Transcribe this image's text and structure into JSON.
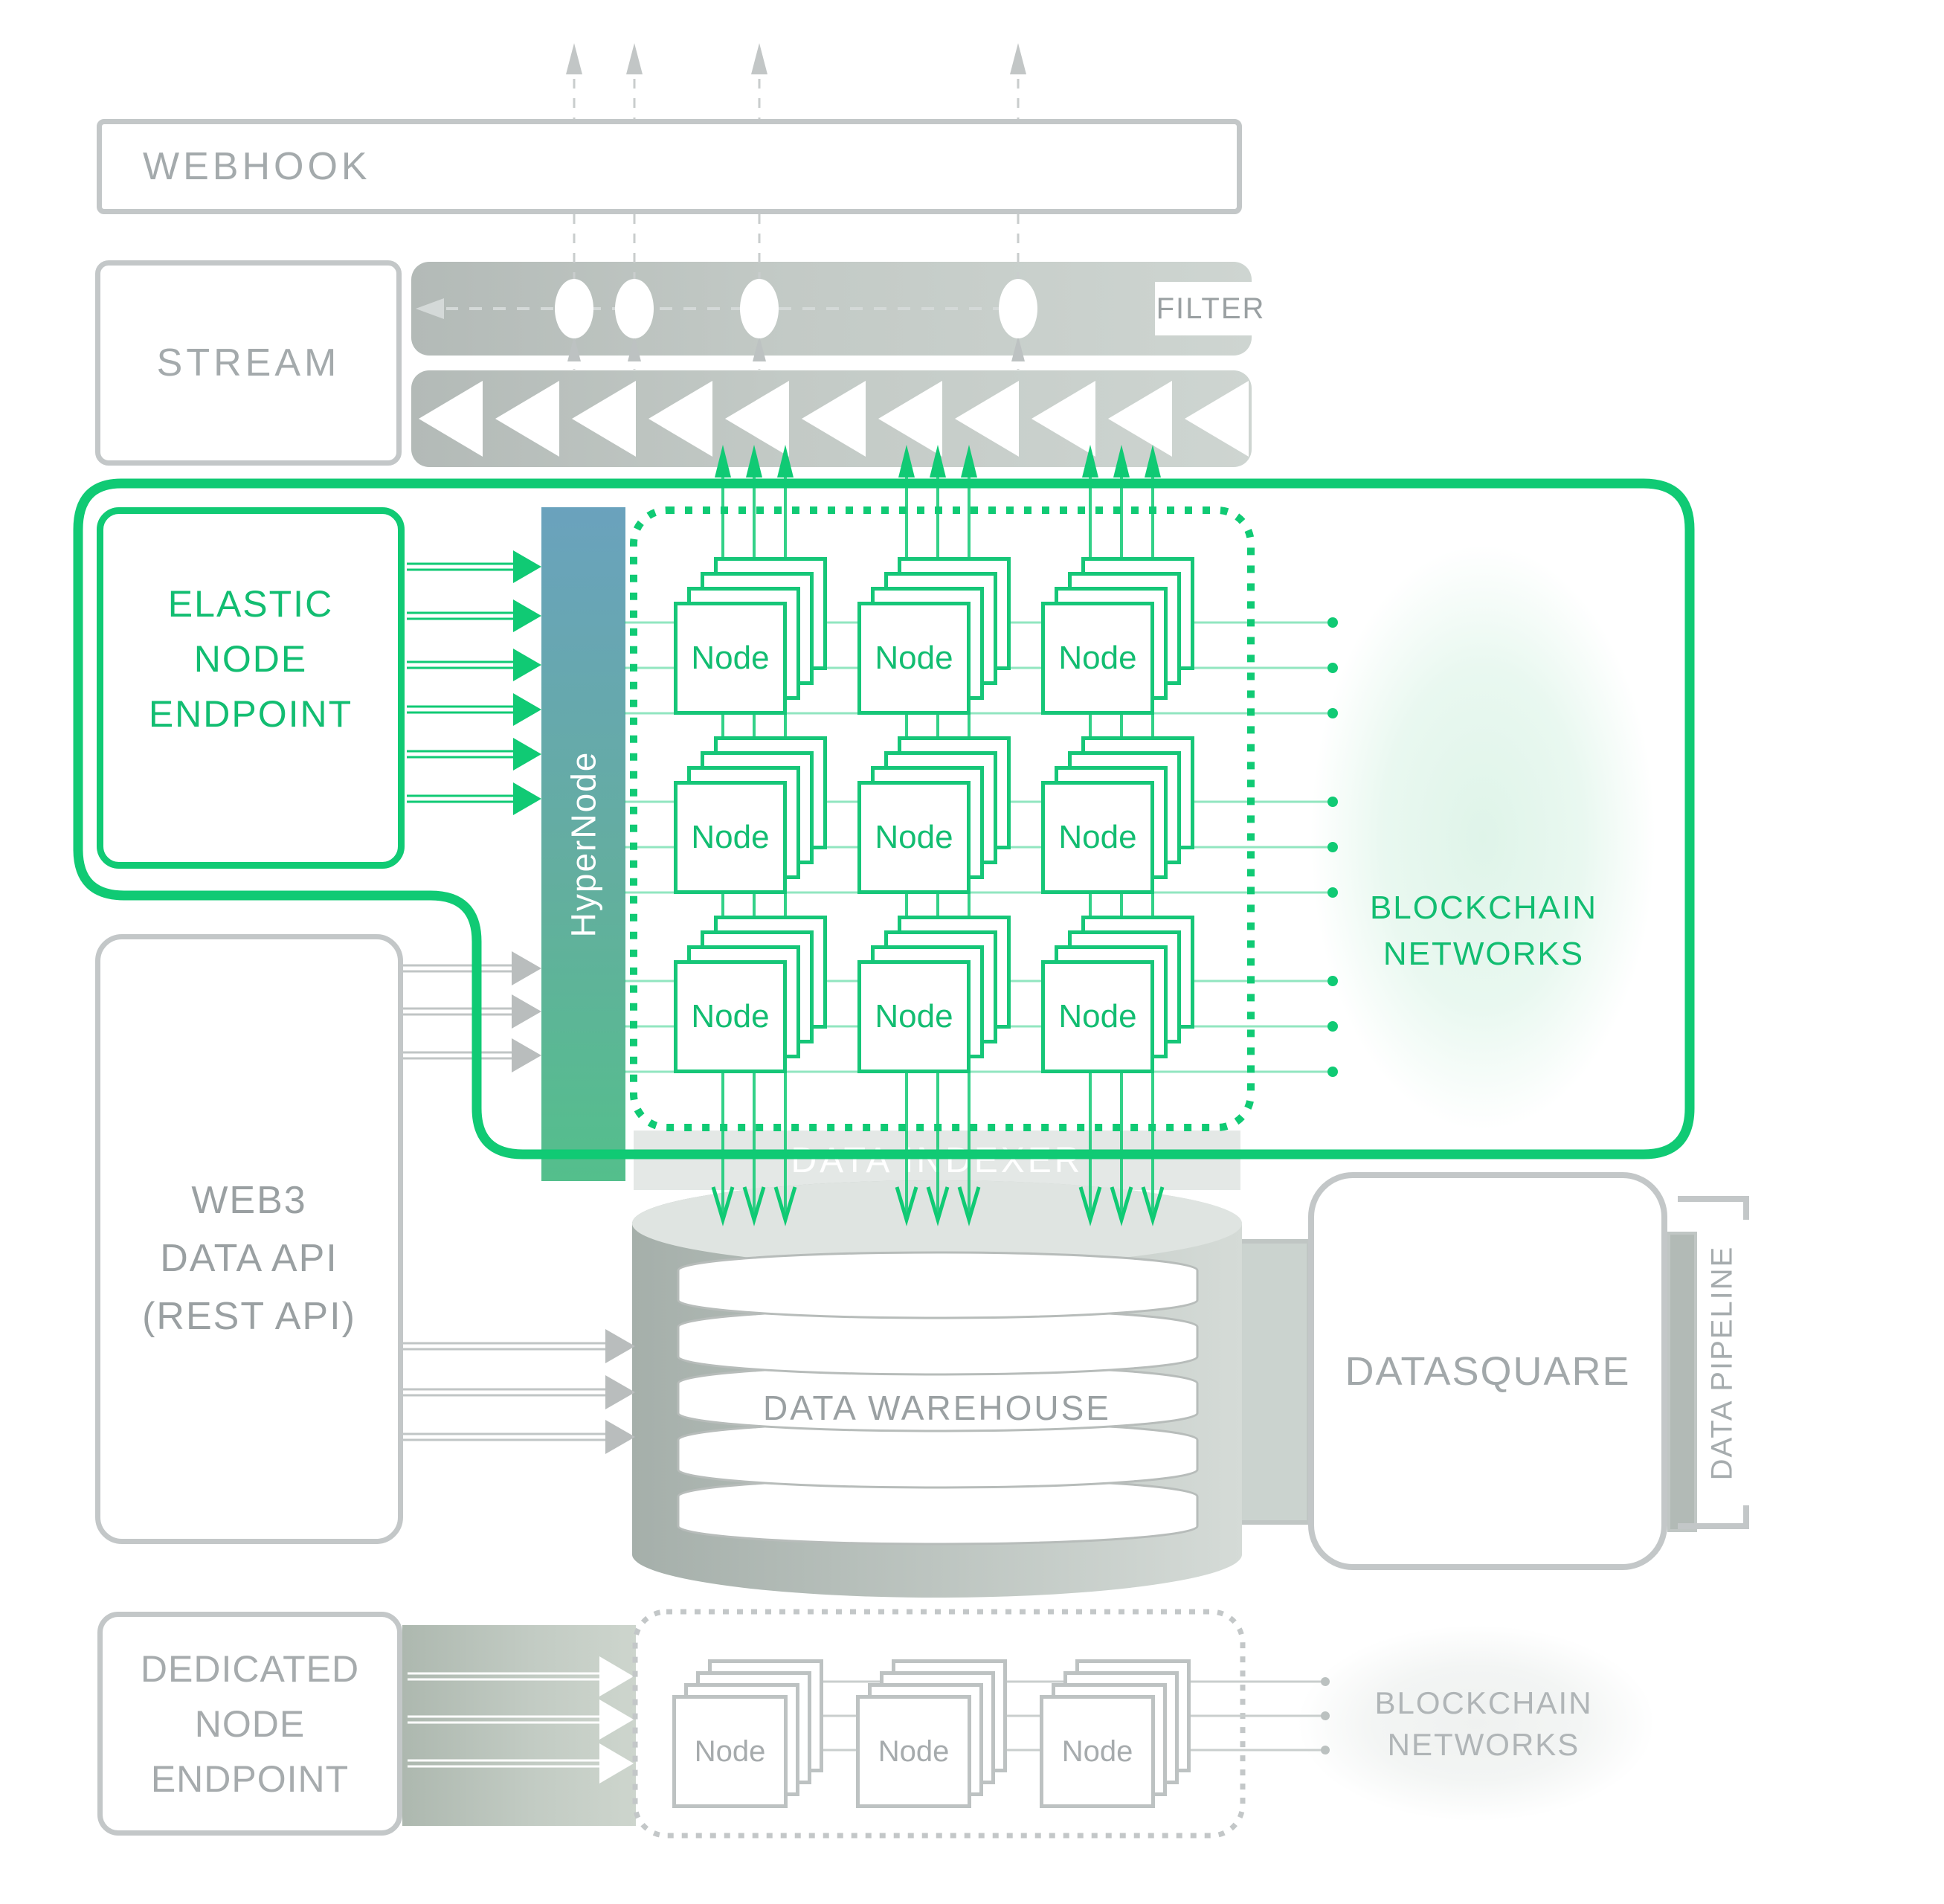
{
  "diagram": {
    "webhook": {
      "label": "WEBHOOK"
    },
    "stream": {
      "label": "STREAM"
    },
    "filter": {
      "label": "FILTER"
    },
    "elastic_endpoint": {
      "lines": [
        "ELASTIC",
        "NODE",
        "ENDPOINT"
      ]
    },
    "hypernode": {
      "label": "HyperNode"
    },
    "node_grid": {
      "node_label": "Node",
      "rows": 3,
      "cols": 3
    },
    "blockchain_networks_top": {
      "lines": [
        "BLOCKCHAIN",
        "NETWORKS"
      ]
    },
    "data_indexer": {
      "label": "DATA INDEXER"
    },
    "web3_api": {
      "lines": [
        "WEB3",
        "DATA API",
        "(REST API)"
      ]
    },
    "data_warehouse": {
      "label": "DATA WAREHOUSE"
    },
    "datasquare": {
      "label": "DATASQUARE"
    },
    "data_pipeline": {
      "label": "DATA PIPELINE"
    },
    "dedicated_endpoint": {
      "lines": [
        "DEDICATED",
        "NODE",
        "ENDPOINT"
      ]
    },
    "dedicated_grid": {
      "node_label": "Node"
    },
    "blockchain_networks_bottom": {
      "lines": [
        "BLOCKCHAIN",
        "NETWORKS"
      ]
    },
    "icons": {
      "up_arrow_dashed": "dashed-up-arrow-icon",
      "left_dashed_arrow": "dashed-left-arrow-icon",
      "stream_triangles": "left-triangle-icon",
      "flow_arrow": "double-line-arrow-icon",
      "endpoint_dot": "connection-dot-icon"
    },
    "colors": {
      "accent_green": "#10ca74",
      "green_text": "#12bd71",
      "gray_border": "#c3c7c8",
      "gray_text": "#9aa0a2",
      "hypernode_top": "#6aa2bd",
      "hypernode_bottom": "#54bf8c",
      "bar_gradient_start": "#b3bab7",
      "bar_gradient_end": "#ced5d1"
    }
  }
}
